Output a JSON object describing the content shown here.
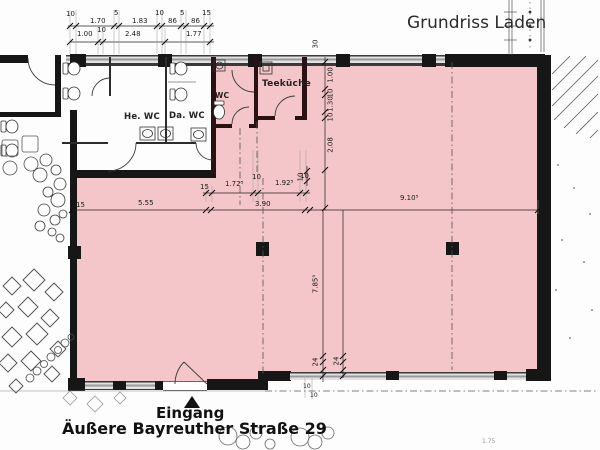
{
  "header": {
    "title": "Grundriss Laden"
  },
  "rooms": {
    "left_wc_men": "He. WC",
    "left_wc_women": "Da. WC",
    "wc_small": "WC",
    "tea_kitchen": "Teeküche"
  },
  "footer": {
    "entrance_label": "Eingang",
    "address": "Äußere Bayreuther Straße 29"
  },
  "dims": {
    "top_row1": [
      "10",
      "1.70",
      "5",
      "1.83",
      "10",
      "86",
      "5",
      "86",
      "15"
    ],
    "top_row2": [
      "1.00",
      "10",
      "2.48",
      "1.77"
    ],
    "vert_upper": [
      "30",
      "1.00",
      "10",
      "1.30",
      "10",
      "2.08",
      "10"
    ],
    "mid_upper": [
      "15",
      "1.72⁵",
      "10",
      "1.92⁵",
      "10"
    ],
    "mid_lower": [
      "15",
      "5.55",
      "3.90",
      "9.10⁵"
    ],
    "vert_lower": [
      "7.85⁵",
      "24",
      "24",
      "10",
      "10"
    ],
    "misc": [
      "1.75"
    ]
  },
  "colors": {
    "area_fill": "#f5c6c9",
    "wall": "#161616",
    "interior_wall": "#2a1113",
    "window_band_gray": "#9a9a9a"
  }
}
